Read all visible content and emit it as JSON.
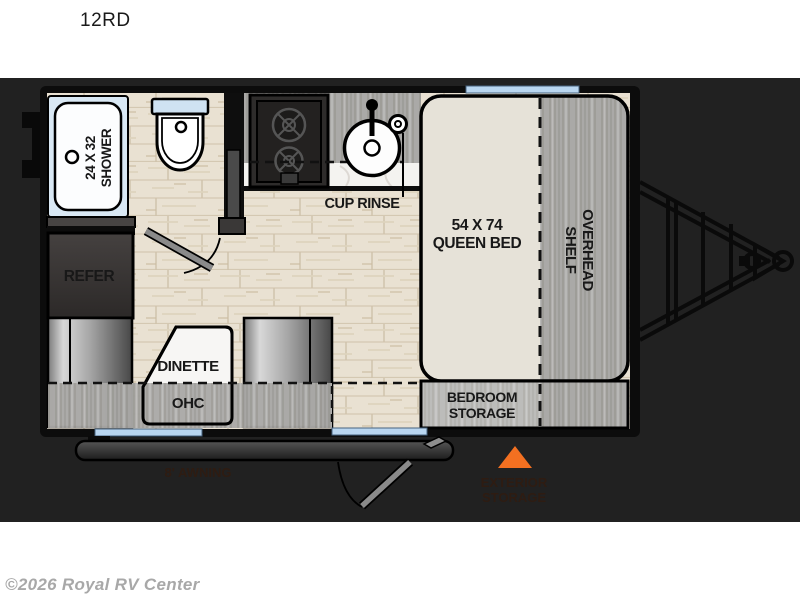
{
  "header": {
    "model_code": "12RD"
  },
  "watermark": {
    "text": "©2026 Royal RV Center"
  },
  "floorplan": {
    "labels": {
      "shower_line1": "24 X 32",
      "shower_line2": "SHOWER",
      "cup_rinse": "CUP RINSE",
      "bed_line1": "54 X 74",
      "bed_line2": "QUEEN BED",
      "shelf_line1": "OVERHEAD",
      "shelf_line2": "SHELF",
      "refrigerator": "REFER",
      "dinette": "DINETTE",
      "ohc": "OHC",
      "bedroom_storage_line1": "BEDROOM",
      "bedroom_storage_line2": "STORAGE",
      "awning_hidden": "8' AWNING",
      "exterior_storage_line1": "EXTERIOR",
      "exterior_storage_line2": "STORAGE"
    },
    "colors": {
      "band_bg": "#212121",
      "accent_orange": "#f37021",
      "window_blue": "#b9d6f0",
      "shower_blue": "#d9e8f4",
      "bed_beige": "#e6e2d8",
      "wall_black": "#0c0c0c",
      "hidden_label_red": "#2e1c12",
      "watermark_gray": "#a8a8a8"
    }
  }
}
